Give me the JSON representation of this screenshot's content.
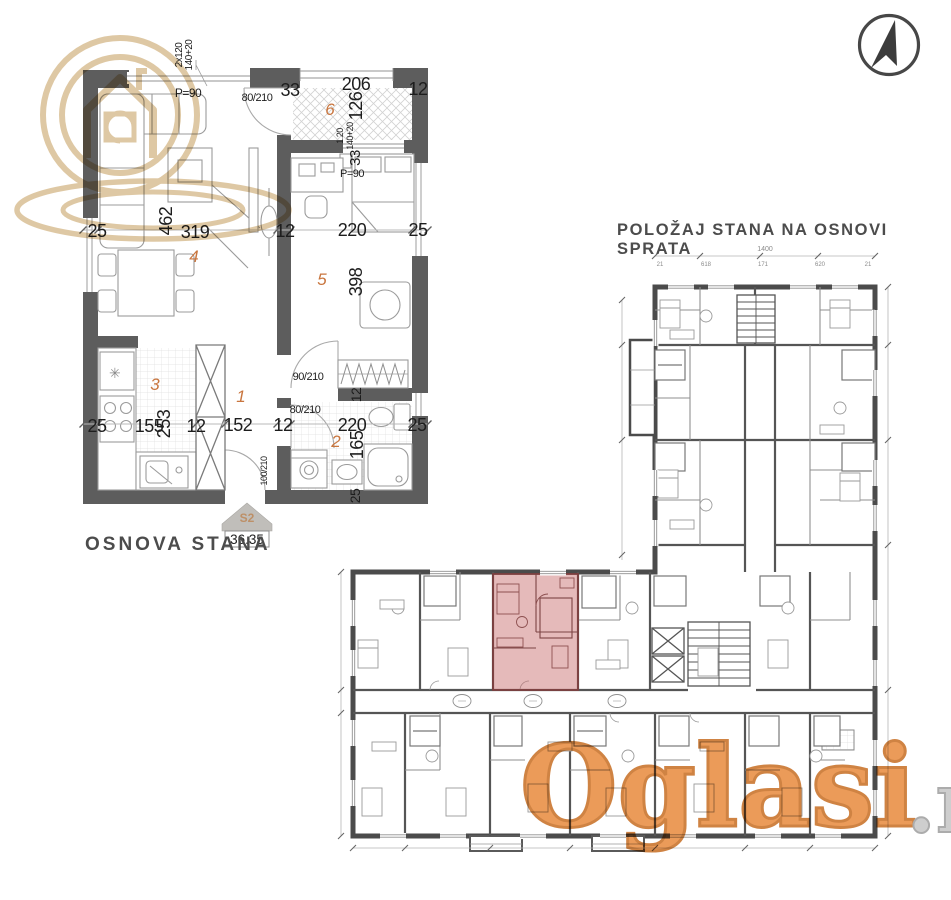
{
  "image": {
    "background": "#ffffff"
  },
  "watermark": {
    "brand": "Oglasi",
    "tld": ".rs",
    "brand_color": "#e8893c",
    "brand_outline": "#c76d22",
    "tld_color": "#c6c6c6",
    "logo_color": "#dcc49c"
  },
  "north_arrow": {
    "direction": "north"
  },
  "left_plan": {
    "title": "OSNOVA STANA",
    "badge": {
      "unit": "S2",
      "area": "36.35"
    },
    "freezer_symbol": "✳",
    "rooms": [
      {
        "t": "1",
        "x": 241,
        "y": 402
      },
      {
        "t": "2",
        "x": 336,
        "y": 447
      },
      {
        "t": "3",
        "x": 155,
        "y": 390
      },
      {
        "t": "4",
        "x": 194,
        "y": 262
      },
      {
        "t": "5",
        "x": 322,
        "y": 285
      },
      {
        "t": "6",
        "x": 330,
        "y": 115
      }
    ],
    "labels": [
      {
        "t": "2x120",
        "x": 182,
        "y": 55,
        "r": -90,
        "s": 10
      },
      {
        "t": "140+20",
        "x": 192,
        "y": 55,
        "r": -90,
        "s": 10
      },
      {
        "t": "P=90",
        "x": 188,
        "y": 97,
        "s": 12
      },
      {
        "t": "80/210",
        "x": 257,
        "y": 101,
        "s": 11
      },
      {
        "t": "33",
        "x": 290,
        "y": 96,
        "s": 18
      },
      {
        "t": "206",
        "x": 356,
        "y": 90,
        "s": 18
      },
      {
        "t": "126",
        "x": 362,
        "y": 106,
        "r": -90,
        "s": 18
      },
      {
        "t": "12",
        "x": 418,
        "y": 95,
        "s": 18
      },
      {
        "t": "1.20",
        "x": 343,
        "y": 136,
        "r": -90,
        "s": 9
      },
      {
        "t": "140+20",
        "x": 353,
        "y": 136,
        "r": -90,
        "s": 9
      },
      {
        "t": "33",
        "x": 360,
        "y": 158,
        "r": -90,
        "s": 15
      },
      {
        "t": "P=90",
        "x": 352,
        "y": 177,
        "s": 11
      },
      {
        "t": "25",
        "x": 97,
        "y": 237,
        "s": 18
      },
      {
        "t": "462",
        "x": 172,
        "y": 221,
        "r": -90,
        "s": 18
      },
      {
        "t": "319",
        "x": 195,
        "y": 238,
        "s": 18
      },
      {
        "t": "12",
        "x": 285,
        "y": 237,
        "s": 18
      },
      {
        "t": "220",
        "x": 352,
        "y": 236,
        "s": 18
      },
      {
        "t": "25",
        "x": 418,
        "y": 236,
        "s": 18
      },
      {
        "t": "398",
        "x": 362,
        "y": 282,
        "r": -90,
        "s": 18
      },
      {
        "t": "90/210",
        "x": 308,
        "y": 380,
        "s": 11
      },
      {
        "t": "12",
        "x": 361,
        "y": 395,
        "r": -90,
        "s": 14
      },
      {
        "t": "80/210",
        "x": 305,
        "y": 413,
        "s": 11
      },
      {
        "t": "25",
        "x": 97,
        "y": 432,
        "s": 18
      },
      {
        "t": "155",
        "x": 149,
        "y": 432,
        "s": 18
      },
      {
        "t": "253",
        "x": 170,
        "y": 424,
        "r": -90,
        "s": 18
      },
      {
        "t": "12",
        "x": 196,
        "y": 432,
        "s": 18
      },
      {
        "t": "152",
        "x": 238,
        "y": 431,
        "s": 18
      },
      {
        "t": "12",
        "x": 283,
        "y": 431,
        "s": 18
      },
      {
        "t": "220",
        "x": 352,
        "y": 431,
        "s": 18
      },
      {
        "t": "165",
        "x": 363,
        "y": 445,
        "r": -90,
        "s": 18
      },
      {
        "t": "25",
        "x": 417,
        "y": 431,
        "s": 18
      },
      {
        "t": "100/210",
        "x": 267,
        "y": 471,
        "r": -90,
        "s": 9
      },
      {
        "t": "25",
        "x": 360,
        "y": 496,
        "r": -90,
        "s": 14
      }
    ]
  },
  "right_plan": {
    "title": "POLOŽAJ STANA NA OSNOVI SPRATA",
    "highlight_color": "#c56666",
    "dims": [
      {
        "t": "1400",
        "x": 765,
        "y": 251,
        "s": 7
      },
      {
        "t": "21",
        "x": 660,
        "y": 266,
        "s": 6
      },
      {
        "t": "618",
        "x": 706,
        "y": 266,
        "s": 6
      },
      {
        "t": "171",
        "x": 763,
        "y": 266,
        "s": 6
      },
      {
        "t": "620",
        "x": 820,
        "y": 266,
        "s": 6
      },
      {
        "t": "21",
        "x": 868,
        "y": 266,
        "s": 6
      }
    ]
  }
}
